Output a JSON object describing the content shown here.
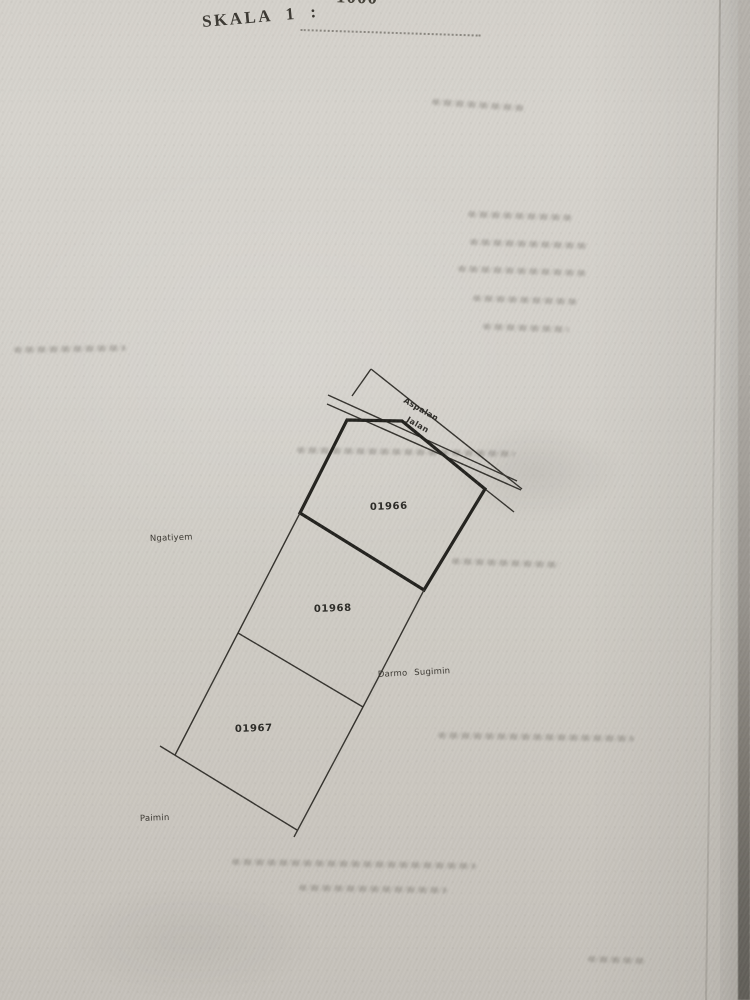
{
  "document": {
    "header": {
      "partial_top_text": "1000",
      "scale_label": "SKALA 1 :"
    },
    "map": {
      "road": {
        "label_upper": "Aspalan",
        "label_lower": "Jalan"
      },
      "parcels": [
        {
          "number": "01966"
        },
        {
          "number": "01968"
        },
        {
          "number": "01967"
        }
      ],
      "owners": [
        {
          "name": "Ngatiyem"
        },
        {
          "name": "Darmo Sugimin"
        },
        {
          "name": "Paimin"
        }
      ]
    },
    "colors": {
      "paper": "#d2cfc8",
      "ink": "#2b2a26",
      "page_edge_dark": "#67645e"
    }
  }
}
